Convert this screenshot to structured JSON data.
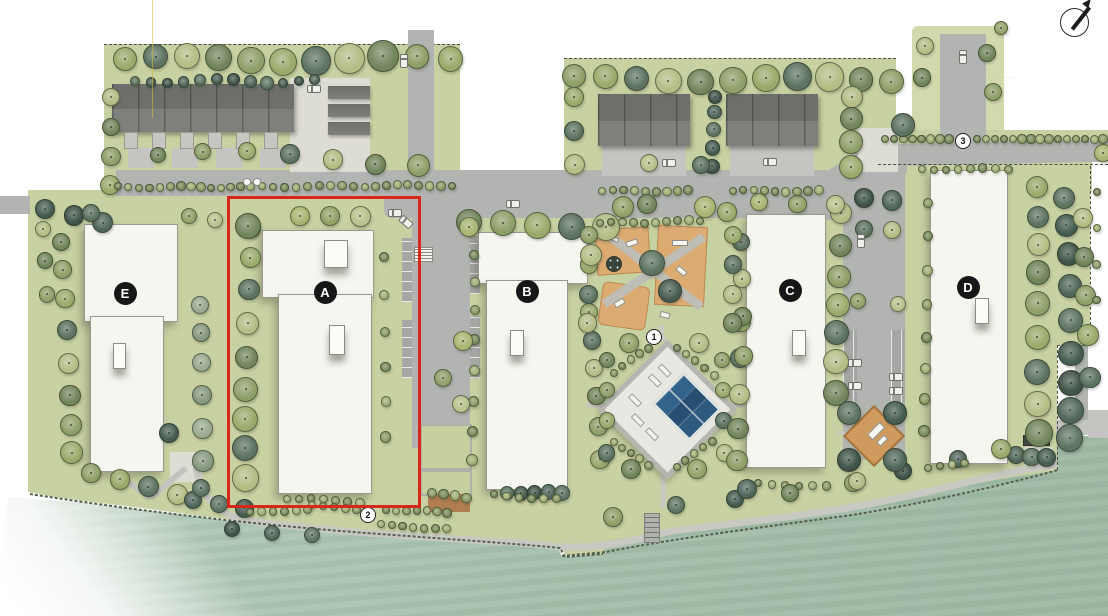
{
  "scene": {
    "type": "landscape-site-plan",
    "description": "Colored landscape site plan of a multi-building residential development along a waterfront open space; Building A parcel outlined in red."
  },
  "buildings": [
    {
      "id": "E",
      "label": "E",
      "x": 125,
      "y": 293
    },
    {
      "id": "A",
      "label": "A",
      "x": 325,
      "y": 292
    },
    {
      "id": "B",
      "label": "B",
      "x": 527,
      "y": 291
    },
    {
      "id": "C",
      "label": "C",
      "x": 790,
      "y": 290
    },
    {
      "id": "D",
      "label": "D",
      "x": 968,
      "y": 287
    }
  ],
  "markers": [
    {
      "n": "1",
      "x": 654,
      "y": 337
    },
    {
      "n": "2",
      "x": 368,
      "y": 515
    },
    {
      "n": "3",
      "x": 963,
      "y": 141
    }
  ],
  "highlight": {
    "color": "#d7281b",
    "x": 227,
    "y": 196,
    "w": 188,
    "h": 306,
    "target": "Building A parcel"
  },
  "annotation": {
    "lines": [
      "····· ···",
      "· ·· ·",
      "········ ··· ·· ···· ·······"
    ]
  },
  "compass": {
    "symbol": "north-arrow"
  },
  "colors": {
    "lawn": "#c8d1a1",
    "water": "#a3bda9",
    "road": "#b2b4b1",
    "building": "#f6f6f1",
    "roof": "#6d6f6a",
    "playground": "#dcab72",
    "pool": "#274f72",
    "highlight_red": "#d7281b",
    "tree_palettes": {
      "mix": [
        "#9aaa6c",
        "#5d7260",
        "#b3bd85",
        "#73855c",
        "#8f9f68"
      ],
      "dark": [
        "#51665a",
        "#5e7362",
        "#475c50",
        "#3f5348"
      ],
      "olv": [
        "#a9b573",
        "#93a268",
        "#b8c28c"
      ],
      "gray": [
        "#87987f",
        "#9aa98f"
      ],
      "shrub": [
        "#8c9c66",
        "#7b8c5c",
        "#a2b077"
      ]
    }
  },
  "vegetation": {
    "rows": [
      [
        122,
        58,
        448,
        58,
        11,
        11,
        15,
        "mix",
        3
      ],
      [
        136,
        80,
        312,
        80,
        12,
        4,
        6,
        "dark",
        2
      ],
      [
        108,
        98,
        108,
        182,
        4,
        8,
        11,
        "mix",
        2
      ],
      [
        152,
        152,
        420,
        160,
        7,
        7,
        12,
        "mix",
        5
      ],
      [
        118,
        186,
        250,
        186,
        14,
        3,
        4,
        "shrub",
        1
      ],
      [
        262,
        186,
        452,
        184,
        18,
        3,
        4,
        "shrub",
        1
      ],
      [
        44,
        210,
        100,
        222,
        3,
        9,
        12,
        "dark",
        2
      ],
      [
        40,
        228,
        46,
        295,
        3,
        7,
        9,
        "mix",
        2
      ],
      [
        62,
        240,
        68,
        452,
        8,
        8,
        11,
        "mix",
        3
      ],
      [
        92,
        474,
        178,
        492,
        4,
        9,
        11,
        "mix",
        2
      ],
      [
        188,
        215,
        214,
        220,
        2,
        7,
        8,
        "olv",
        1
      ],
      [
        197,
        303,
        205,
        457,
        6,
        8,
        11,
        "gray",
        3
      ],
      [
        190,
        497,
        242,
        509,
        3,
        8,
        10,
        "dark",
        2
      ],
      [
        250,
        512,
        306,
        508,
        6,
        3,
        4,
        "shrub",
        1
      ],
      [
        247,
        228,
        247,
        480,
        9,
        9,
        13,
        "mix",
        3
      ],
      [
        300,
        214,
        360,
        216,
        3,
        9,
        10,
        "olv",
        1
      ],
      [
        383,
        256,
        383,
        438,
        6,
        4,
        5,
        "shrub",
        2
      ],
      [
        285,
        497,
        360,
        501,
        7,
        3,
        4,
        "shrub",
        1
      ],
      [
        432,
        492,
        466,
        497,
        4,
        4,
        5,
        "shrub",
        1
      ],
      [
        472,
        252,
        472,
        458,
        8,
        4,
        5,
        "shrub",
        2
      ],
      [
        590,
        308,
        596,
        458,
        6,
        8,
        9,
        "mix",
        3
      ],
      [
        508,
        490,
        560,
        494,
        5,
        6,
        8,
        "dark",
        2
      ],
      [
        492,
        494,
        556,
        498,
        6,
        3,
        4,
        "shrub",
        1
      ],
      [
        470,
        223,
        604,
        224,
        5,
        12,
        14,
        "mix",
        2
      ],
      [
        612,
        372,
        648,
        347,
        5,
        3,
        4,
        "shrub",
        1
      ],
      [
        676,
        347,
        714,
        374,
        5,
        3,
        4,
        "shrub",
        1
      ],
      [
        612,
        440,
        648,
        465,
        5,
        3,
        4,
        "shrub",
        1
      ],
      [
        676,
        465,
        712,
        441,
        5,
        3,
        4,
        "shrub",
        1
      ],
      [
        604,
        360,
        604,
        452,
        4,
        7,
        9,
        "mix",
        2
      ],
      [
        722,
        360,
        722,
        452,
        4,
        7,
        9,
        "mix",
        2
      ],
      [
        737,
        324,
        737,
        458,
        5,
        9,
        11,
        "mix",
        3
      ],
      [
        741,
        240,
        741,
        356,
        4,
        8,
        10,
        "mix",
        2
      ],
      [
        838,
        212,
        838,
        394,
        7,
        10,
        13,
        "mix",
        3
      ],
      [
        756,
        200,
        834,
        202,
        3,
        8,
        10,
        "olv",
        2
      ],
      [
        756,
        482,
        826,
        486,
        6,
        3,
        4,
        "shrub",
        1
      ],
      [
        862,
        198,
        890,
        200,
        2,
        9,
        11,
        "dark",
        1
      ],
      [
        862,
        228,
        890,
        230,
        2,
        8,
        10,
        "mix",
        1
      ],
      [
        856,
        300,
        896,
        302,
        2,
        7,
        8,
        "olv",
        1
      ],
      [
        920,
        168,
        1008,
        168,
        8,
        3,
        4,
        "shrub",
        1
      ],
      [
        925,
        204,
        925,
        432,
        8,
        4,
        5,
        "shrub",
        2
      ],
      [
        1032,
        182,
        1042,
        430,
        9,
        10,
        13,
        "mix",
        4
      ],
      [
        1062,
        196,
        1070,
        440,
        9,
        10,
        13,
        "dark",
        4
      ],
      [
        1085,
        214,
        1090,
        378,
        5,
        9,
        11,
        "mix",
        3
      ],
      [
        1096,
        192,
        1096,
        298,
        4,
        3,
        4,
        "shrub",
        1
      ],
      [
        1014,
        452,
        1046,
        456,
        3,
        8,
        10,
        "dark",
        2
      ],
      [
        884,
        138,
        948,
        138,
        8,
        3,
        4,
        "shrub",
        0
      ],
      [
        976,
        138,
        1102,
        138,
        15,
        3,
        4,
        "shrub",
        0
      ],
      [
        924,
        44,
        920,
        76,
        2,
        8,
        9,
        "mix",
        1
      ],
      [
        986,
        52,
        992,
        92,
        2,
        8,
        9,
        "mix",
        1
      ],
      [
        576,
        78,
        888,
        78,
        11,
        11,
        14,
        "mix",
        3
      ],
      [
        572,
        98,
        572,
        162,
        3,
        9,
        11,
        "mix",
        2
      ],
      [
        712,
        96,
        712,
        164,
        5,
        6,
        8,
        "dark",
        2
      ],
      [
        852,
        96,
        852,
        166,
        4,
        10,
        13,
        "mix",
        2
      ],
      [
        602,
        190,
        686,
        190,
        9,
        3,
        4,
        "shrub",
        1
      ],
      [
        732,
        190,
        818,
        190,
        9,
        3,
        4,
        "shrub",
        1
      ],
      [
        232,
        527,
        310,
        533,
        3,
        7,
        8,
        "dark",
        2
      ],
      [
        380,
        524,
        446,
        528,
        7,
        3,
        4,
        "shrub",
        1
      ],
      [
        674,
        504,
        733,
        499,
        2,
        8,
        9,
        "dark",
        1
      ],
      [
        788,
        492,
        852,
        483,
        2,
        8,
        9,
        "mix",
        1
      ],
      [
        902,
        470,
        958,
        457,
        2,
        8,
        9,
        "dark",
        1
      ],
      [
        928,
        468,
        964,
        461,
        4,
        3,
        4,
        "shrub",
        1
      ],
      [
        384,
        508,
        446,
        512,
        7,
        3,
        4,
        "shrub",
        1
      ],
      [
        310,
        505,
        356,
        508,
        5,
        3,
        4,
        "shrub",
        1
      ],
      [
        598,
        222,
        700,
        220,
        10,
        3,
        4,
        "shrub",
        1
      ],
      [
        586,
        236,
        586,
        320,
        4,
        8,
        10,
        "mix",
        2
      ],
      [
        730,
        236,
        730,
        320,
        4,
        8,
        10,
        "mix",
        2
      ]
    ],
    "singles": [
      [
        468,
        226,
        9,
        "olv"
      ],
      [
        628,
        342,
        9,
        "olv"
      ],
      [
        698,
        342,
        9,
        "mix"
      ],
      [
        630,
        468,
        9,
        "mix"
      ],
      [
        696,
        468,
        9,
        "olv"
      ],
      [
        648,
        162,
        8,
        "olv"
      ],
      [
        700,
        164,
        8,
        "mix"
      ],
      [
        622,
        206,
        10,
        "olv"
      ],
      [
        646,
        203,
        9,
        "mix"
      ],
      [
        704,
        206,
        10,
        "olv"
      ],
      [
        726,
        211,
        9,
        "mix"
      ],
      [
        902,
        124,
        11,
        "mix"
      ],
      [
        1102,
        152,
        8,
        "olv"
      ],
      [
        1000,
        27,
        6,
        "olv"
      ],
      [
        612,
        516,
        9,
        "mix"
      ],
      [
        1000,
        448,
        9,
        "mix"
      ],
      [
        746,
        488,
        9,
        "dark"
      ],
      [
        856,
        480,
        8,
        "mix"
      ],
      [
        462,
        340,
        9,
        "olv"
      ],
      [
        442,
        377,
        8,
        "mix"
      ],
      [
        460,
        403,
        8,
        "olv"
      ],
      [
        848,
        412,
        11,
        "dark"
      ],
      [
        894,
        412,
        11,
        "dark"
      ],
      [
        848,
        459,
        11,
        "dark"
      ],
      [
        894,
        459,
        11,
        "dark"
      ],
      [
        651,
        262,
        12,
        "dark"
      ],
      [
        669,
        290,
        11,
        "dark"
      ],
      [
        590,
        254,
        10,
        "mix"
      ],
      [
        247,
        225,
        12,
        "mix"
      ],
      [
        200,
        487,
        8,
        "dark"
      ],
      [
        168,
        432,
        9,
        "dark"
      ],
      [
        90,
        212,
        8,
        "mix"
      ]
    ]
  },
  "cars": [
    [
      403,
      60,
      90
    ],
    [
      962,
      56,
      90
    ],
    [
      313,
      88,
      0
    ],
    [
      668,
      162,
      0
    ],
    [
      769,
      161,
      0
    ],
    [
      394,
      212,
      0
    ],
    [
      512,
      203,
      0
    ],
    [
      405,
      221,
      40
    ],
    [
      860,
      240,
      90
    ],
    [
      854,
      362,
      0
    ],
    [
      854,
      385,
      0
    ],
    [
      895,
      376,
      0
    ],
    [
      895,
      390,
      0
    ]
  ],
  "white_dots": [
    [
      246,
      181
    ],
    [
      256,
      181
    ]
  ]
}
